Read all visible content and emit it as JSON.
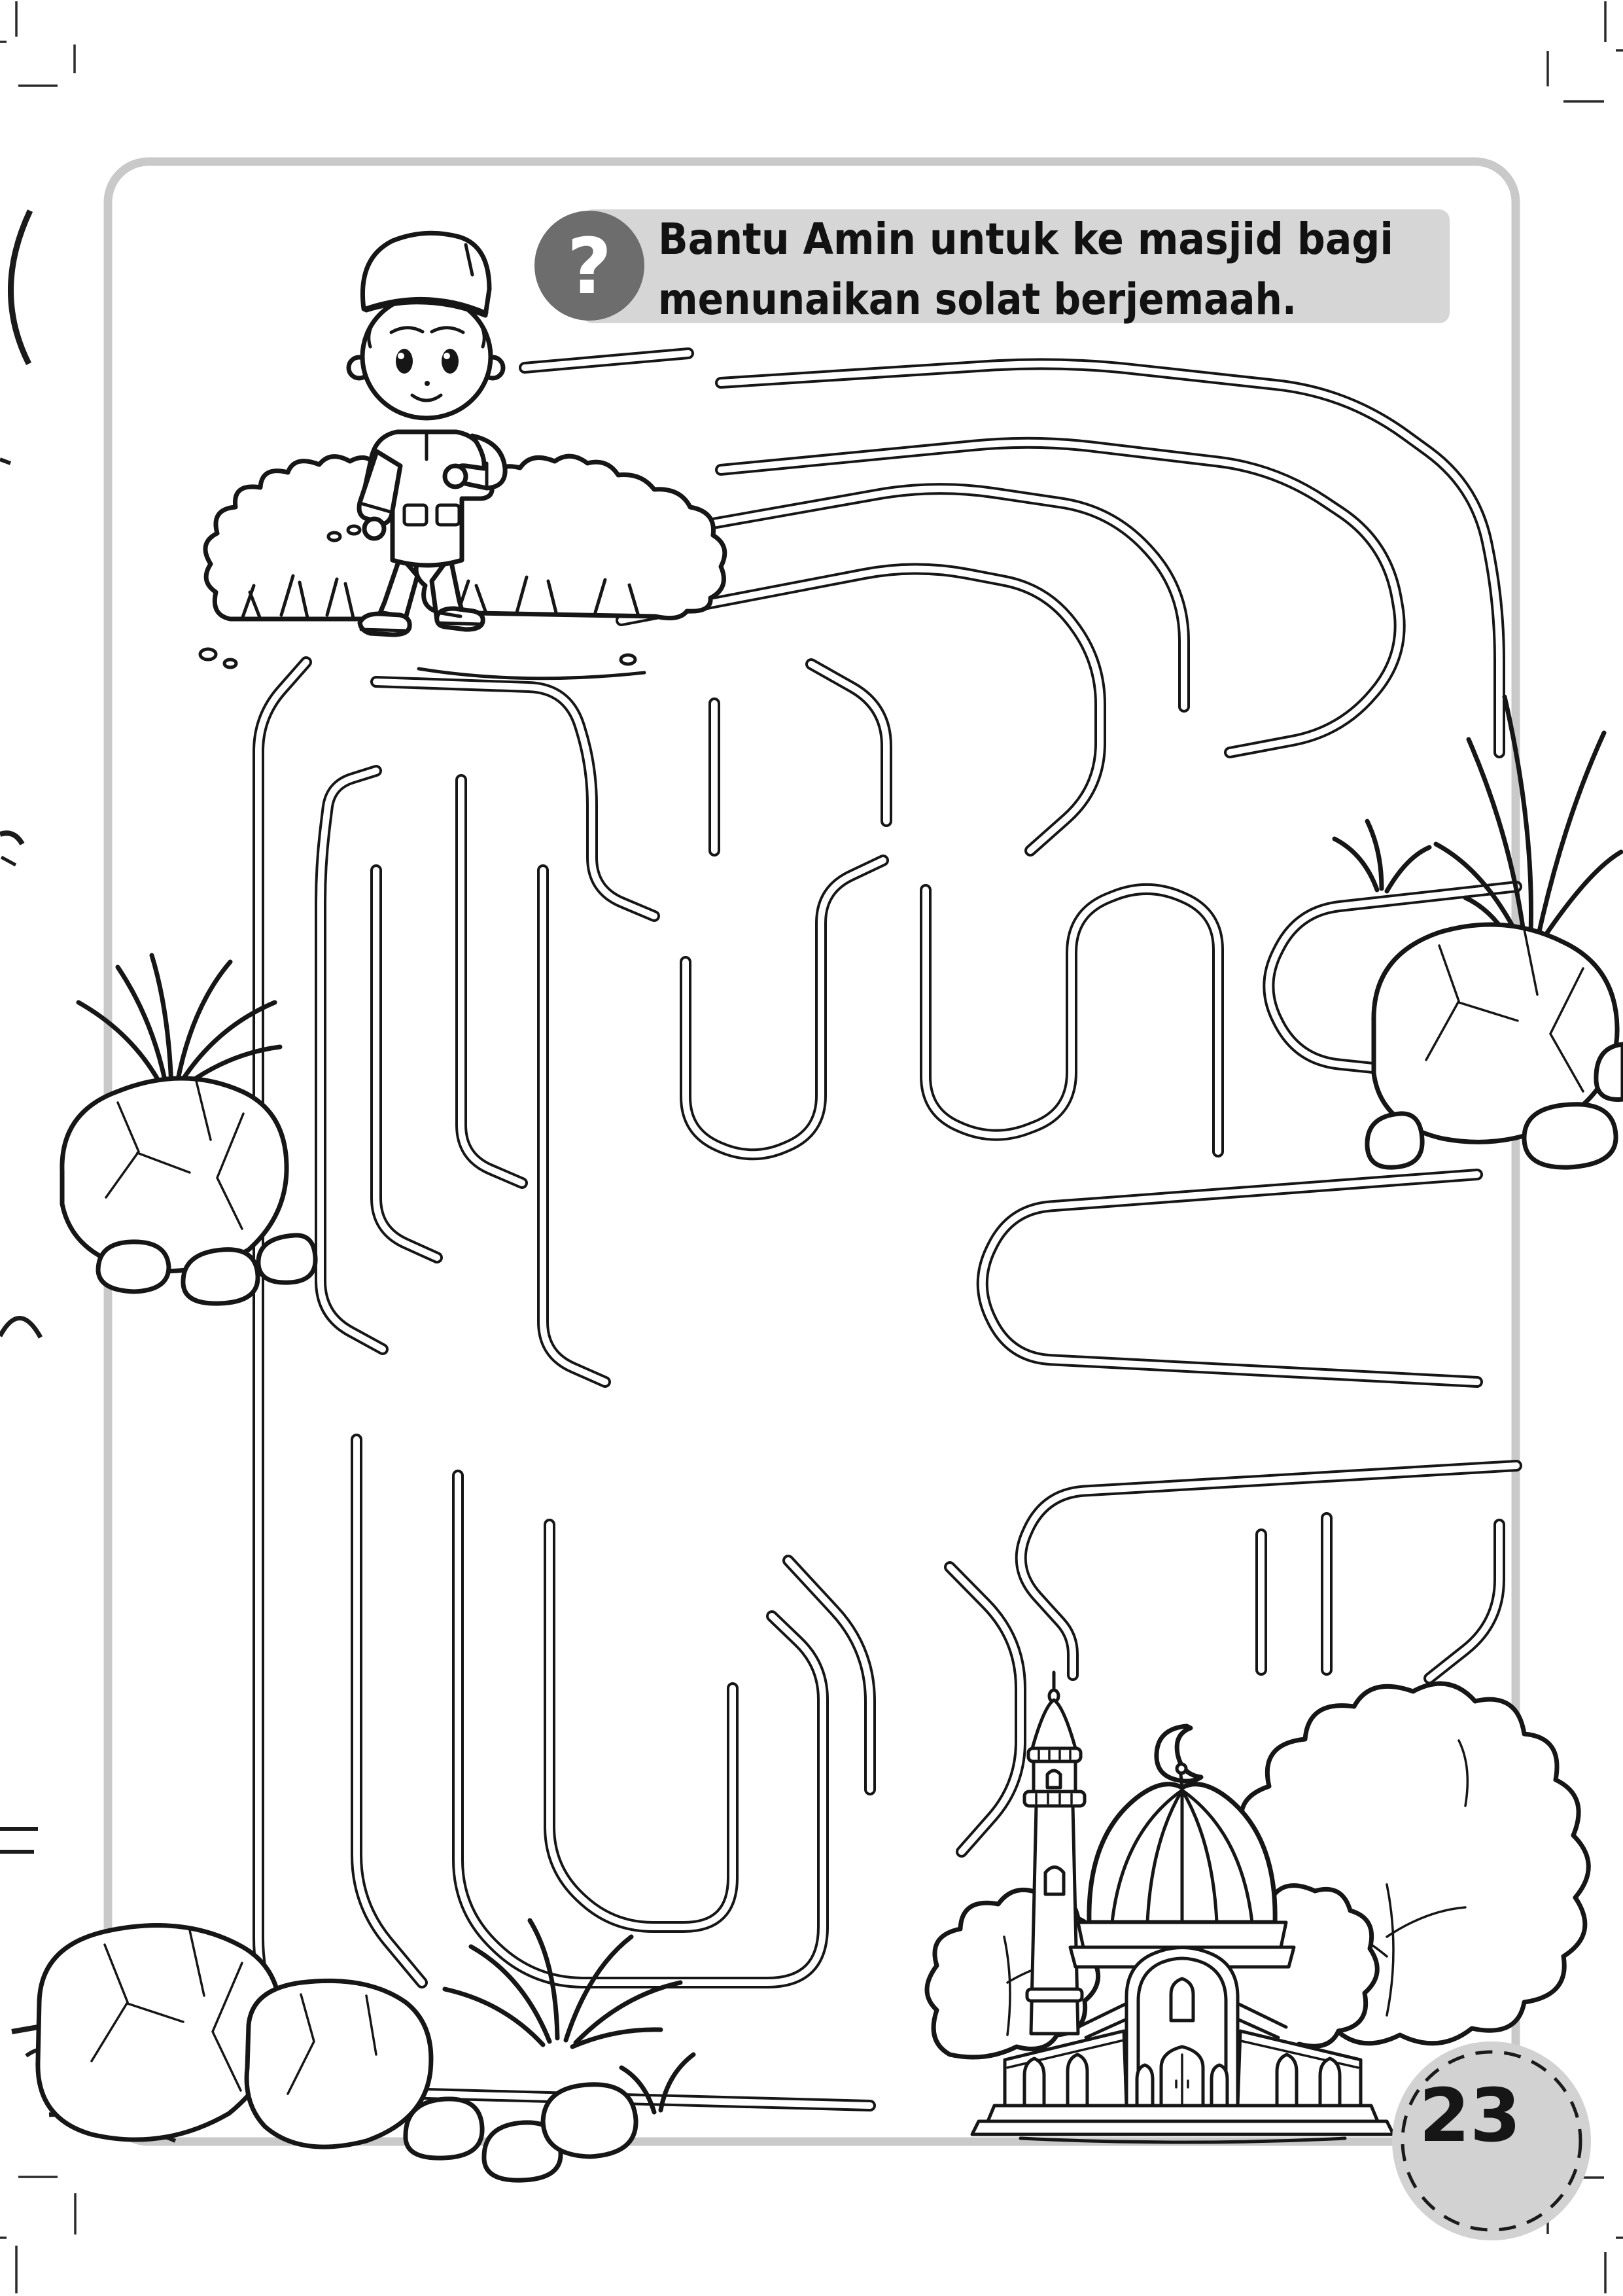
{
  "header": {
    "badge_glyph": "?",
    "instruction_line1": "Bantu Amin untuk ke masjid bagi",
    "instruction_line2": "menunaikan solat berjemaah.",
    "bar_color": "#d6d6d6",
    "badge_color": "#6d6d6d",
    "text_color": "#121212"
  },
  "footer": {
    "page_number": "23",
    "badge_fill": "#d2d2d2"
  },
  "page": {
    "paper_color": "#ffffff",
    "border_color": "#c9c9c9",
    "ink_color": "#161616"
  },
  "illustrations": {
    "start": "boy-walking",
    "goal": "mosque",
    "decorations": "bushes, grass, rocks, trees"
  }
}
